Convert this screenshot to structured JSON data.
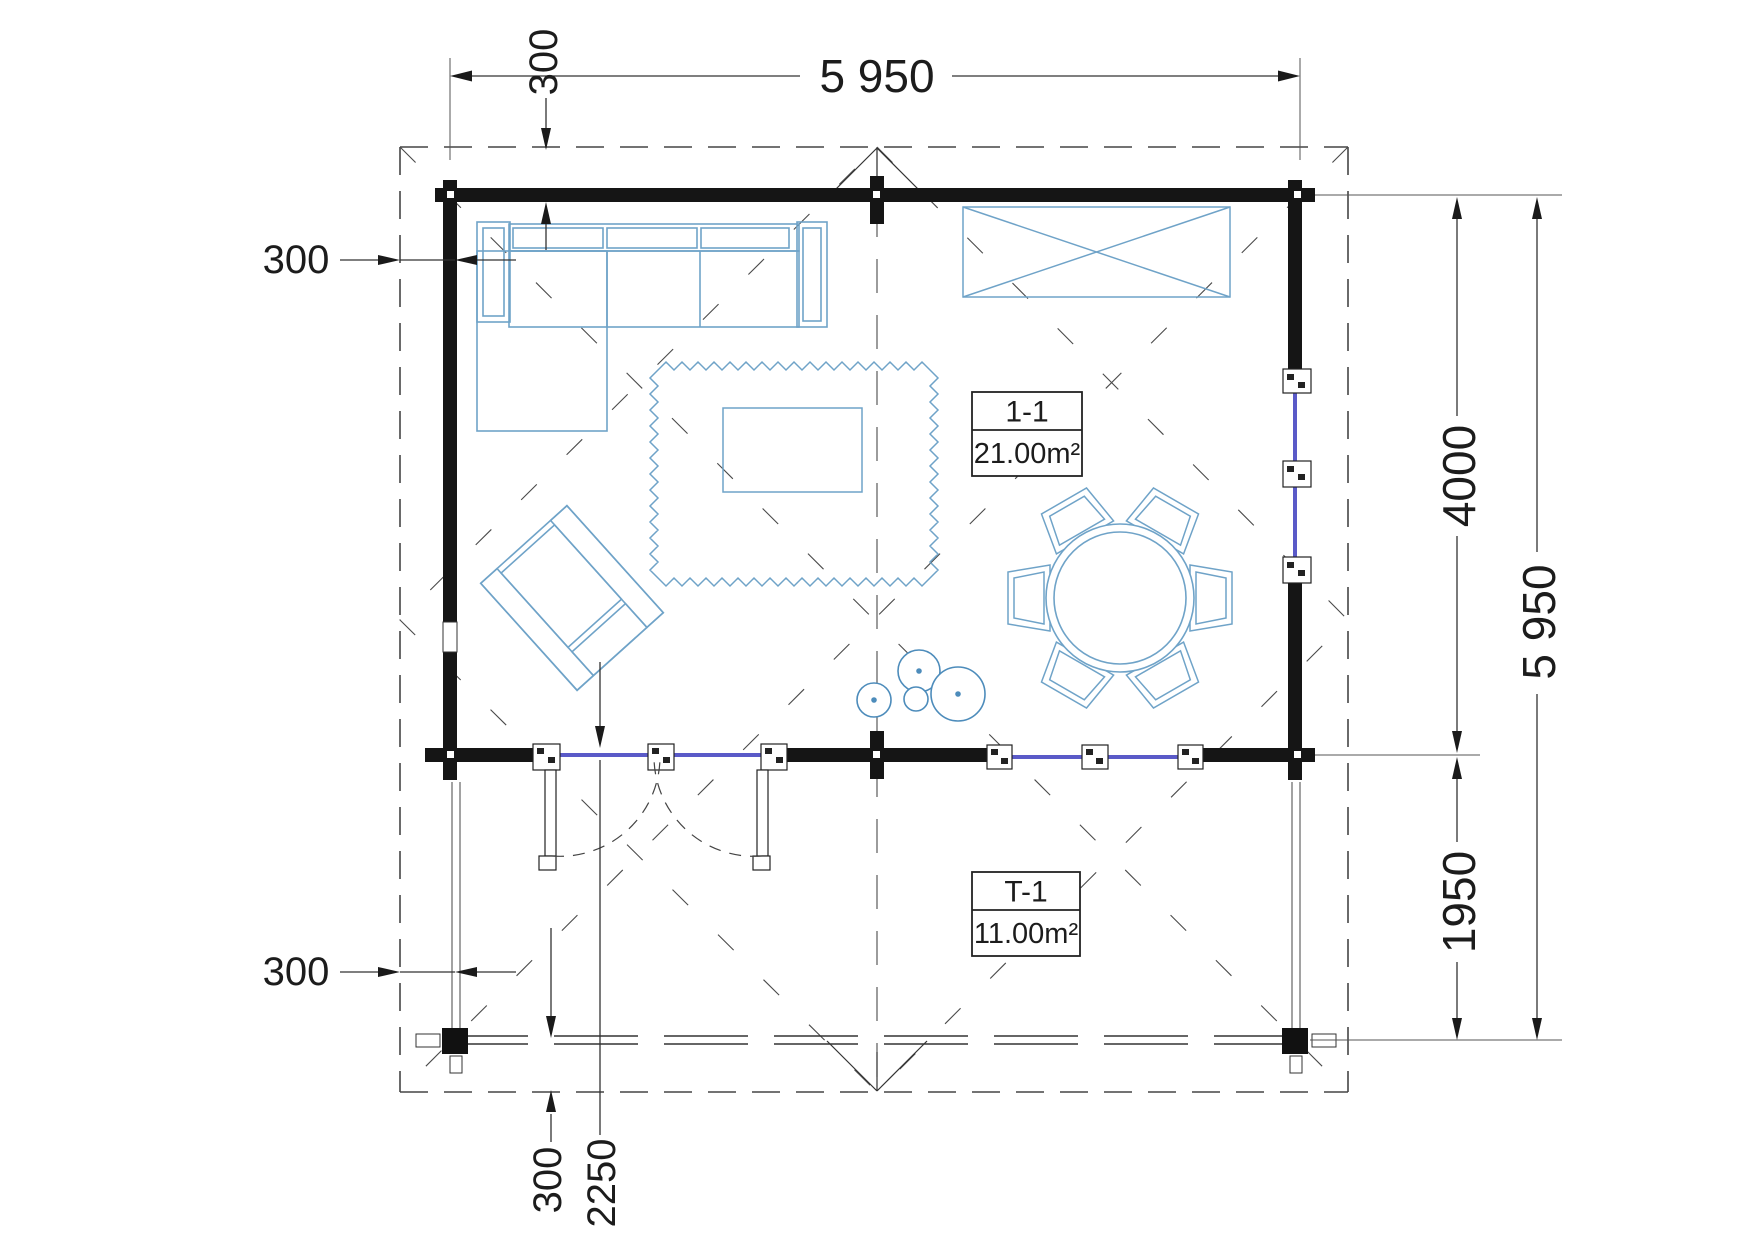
{
  "drawing": {
    "type": "architectural floor plan, cabin with terrace, top view",
    "colors": {
      "wall": "#151515",
      "furniture_line": "#6fa3c8",
      "plant_line": "#4d8cbb",
      "glazing": "#5a5ac8",
      "dimension_line": "#333333",
      "roof_dash": "#454545"
    },
    "dims": {
      "width_total": "5 950",
      "height_total": "5 950",
      "height_main": "4000",
      "height_terrace": "1950",
      "overhang_top": "300",
      "overhang_left": "300",
      "overhang_bottom_left": "300",
      "overhang_bottom": "300",
      "door_offset": "2250"
    },
    "rooms": {
      "main": {
        "code": "1-1",
        "area": "21.00m²"
      },
      "terrace": {
        "code": "T-1",
        "area": "11.00m²"
      }
    }
  }
}
